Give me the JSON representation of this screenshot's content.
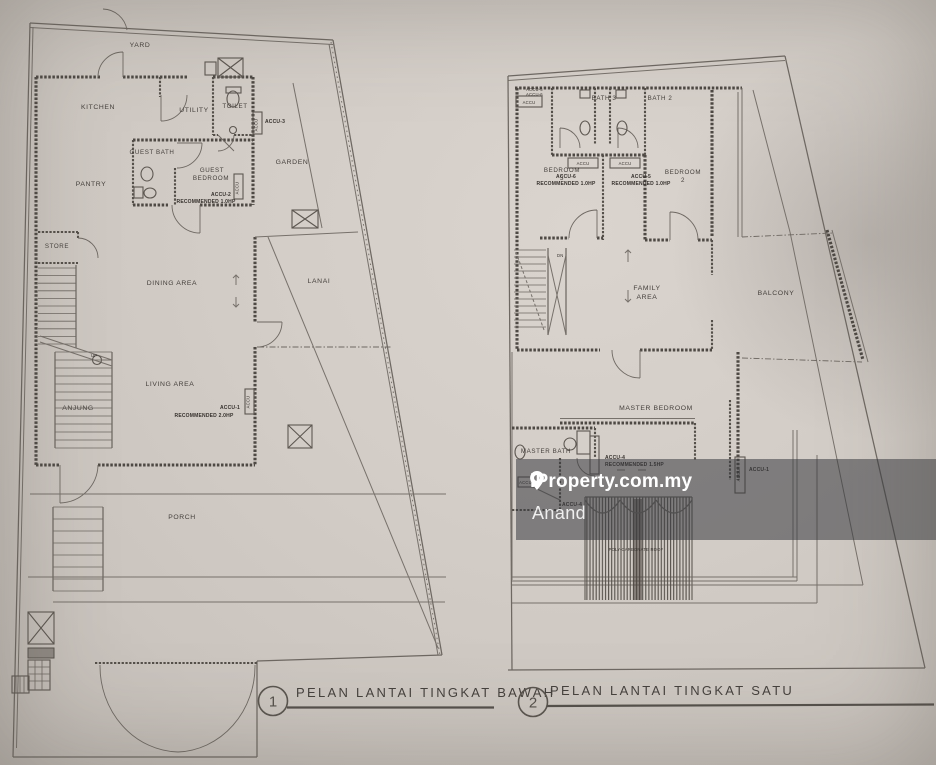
{
  "watermark": {
    "brand": "iProperty.com.my",
    "username": "Anand"
  },
  "plan_titles": {
    "ground": {
      "number": "1",
      "label": "PELAN LANTAI TINGKAT BAWAH"
    },
    "first": {
      "number": "2",
      "label": "PELAN LANTAI TINGKAT SATU"
    }
  },
  "ground_floor": {
    "yard": "YARD",
    "kitchen": "KITCHEN",
    "utility": "UTILITY",
    "toilet": "TOILET",
    "guest_bath": "GUEST BATH",
    "guest_bedroom_l1": "GUEST",
    "guest_bedroom_l2": "BEDROOM",
    "garden": "GARDEN",
    "pantry": "PANTRY",
    "store": "STORE",
    "dining": "DINING AREA",
    "lanai": "LANAI",
    "living": "LIVING AREA",
    "anjung": "ANJUNG",
    "porch": "PORCH",
    "up": "UP",
    "accu_box": "ACCU",
    "accu3": "ACCU-3",
    "accu2": "ACCU-2",
    "accu2_rec": "RECOMMENDED 1.0HP",
    "accu1": "ACCU-1",
    "accu1_rec": "RECOMMENDED 2.0HP"
  },
  "first_floor": {
    "bath3": "BATH 3",
    "bath2": "BATH 2",
    "bedroom3_l1": "BEDROOM",
    "bedroom3_l2": "3",
    "bedroom2_l1": "BEDROOM",
    "bedroom2_l2": "2",
    "family_l1": "FAMILY",
    "family_l2": "AREA",
    "balcony": "BALCONY",
    "down": "DN",
    "master_bedroom": "MASTER BEDROOM",
    "master_bath": "MASTER BATH",
    "accu_box": "ACCU",
    "accu_corner_l1": "ACCU-5",
    "accu_corner_l2": "ACCU-6",
    "accu6": "ACCU-6",
    "accu6_rec": "RECOMMENDED 1.0HP",
    "accu5": "ACCU-5",
    "accu5_rec": "RECOMMENDED 1.0HP",
    "accu4": "ACCU-4",
    "accu4_rec": "RECOMMENDED 1.5HP",
    "accu4_small": "ACCU-4",
    "accu1": "ACCU-1",
    "poly_roof": "POLY-CARBONATE ROOF"
  }
}
